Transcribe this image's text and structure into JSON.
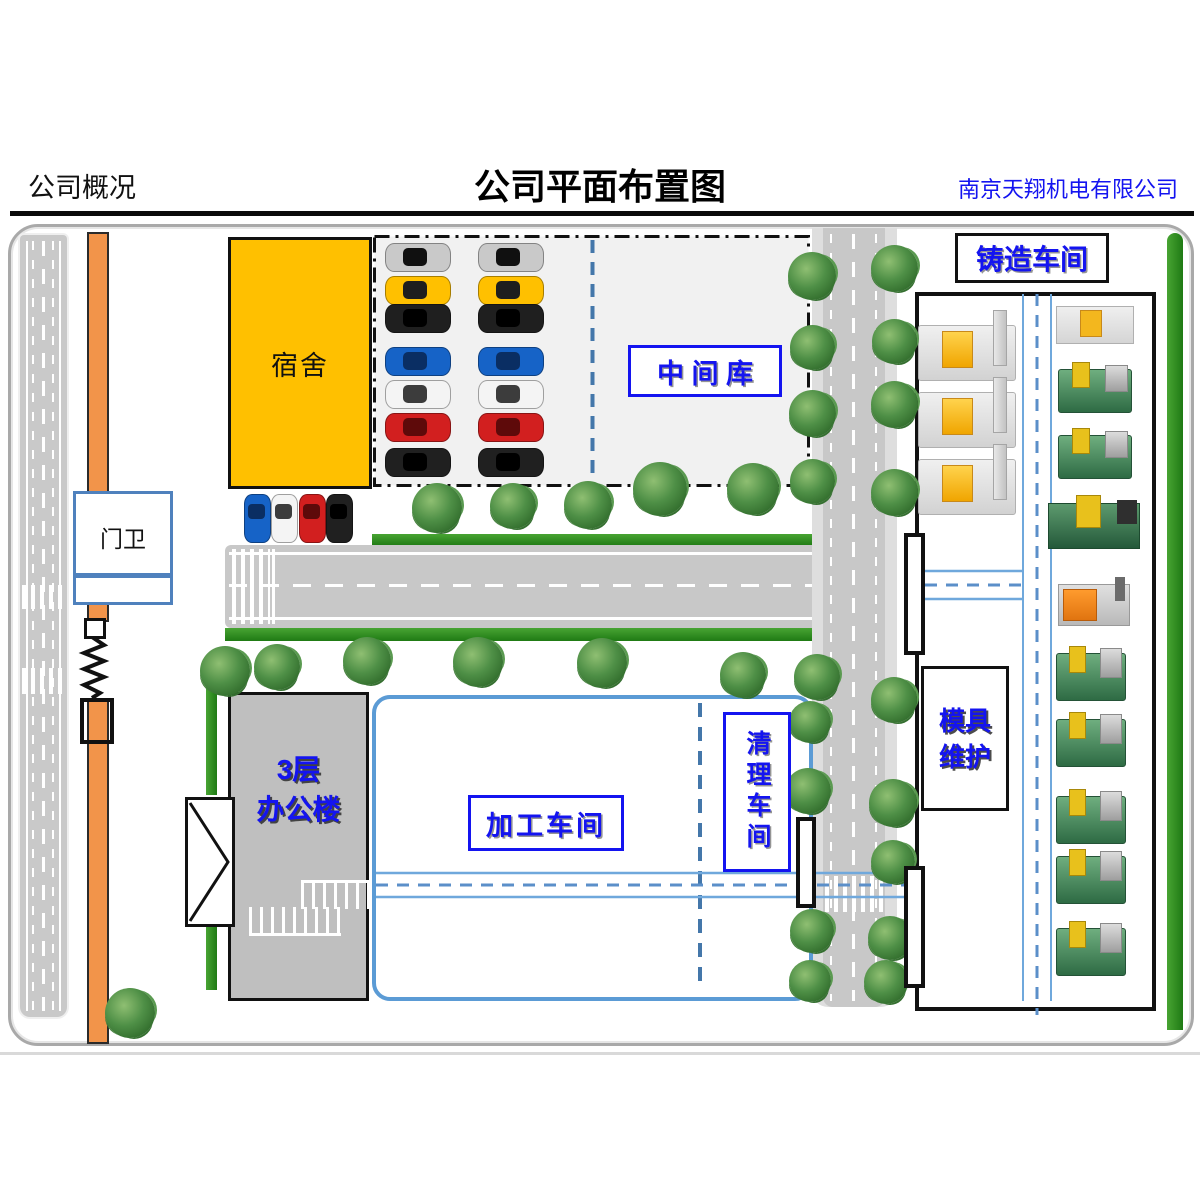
{
  "header": {
    "section_label": "公司概况",
    "title": "公司平面布置图",
    "company_name": "南京天翔机电有限公司"
  },
  "labels": {
    "dormitory": "宿舍",
    "gatehouse": "门卫",
    "intermediate_warehouse": "中 间 库",
    "casting_workshop": "铸造车间",
    "mold_maintenance_line1": "模具",
    "mold_maintenance_line2": "维护",
    "office_line1": "3层",
    "office_line2": "办公楼",
    "processing_workshop": "加工车间",
    "cleaning_workshop": "清理车间"
  },
  "colors": {
    "label_blue": "#1414f0",
    "box_border_blue": "#5b9bd5",
    "aisle_blue": "#6fa8dc",
    "dormitory_fill": "#ffc000",
    "wall_orange": "#f2944a",
    "road_gray": "#c8c8c8",
    "grass_green": "#2f8f22",
    "parking_fill": "#f1f1f1"
  },
  "map_objects": {
    "trees": [
      {
        "x": 812,
        "y": 276,
        "d": 48
      },
      {
        "x": 812,
        "y": 347,
        "d": 45
      },
      {
        "x": 812,
        "y": 413,
        "d": 47
      },
      {
        "x": 812,
        "y": 481,
        "d": 45
      },
      {
        "x": 894,
        "y": 268,
        "d": 47
      },
      {
        "x": 894,
        "y": 341,
        "d": 45
      },
      {
        "x": 894,
        "y": 404,
        "d": 47
      },
      {
        "x": 894,
        "y": 492,
        "d": 47
      },
      {
        "x": 437,
        "y": 508,
        "d": 50
      },
      {
        "x": 513,
        "y": 506,
        "d": 46
      },
      {
        "x": 588,
        "y": 505,
        "d": 48
      },
      {
        "x": 660,
        "y": 489,
        "d": 54
      },
      {
        "x": 753,
        "y": 489,
        "d": 52
      },
      {
        "x": 225,
        "y": 671,
        "d": 50
      },
      {
        "x": 277,
        "y": 667,
        "d": 46
      },
      {
        "x": 367,
        "y": 661,
        "d": 48
      },
      {
        "x": 478,
        "y": 662,
        "d": 50
      },
      {
        "x": 602,
        "y": 663,
        "d": 50
      },
      {
        "x": 743,
        "y": 675,
        "d": 46
      },
      {
        "x": 817,
        "y": 677,
        "d": 46
      },
      {
        "x": 810,
        "y": 722,
        "d": 42
      },
      {
        "x": 808,
        "y": 791,
        "d": 46
      },
      {
        "x": 812,
        "y": 931,
        "d": 44
      },
      {
        "x": 810,
        "y": 981,
        "d": 42
      },
      {
        "x": 894,
        "y": 700,
        "d": 46
      },
      {
        "x": 893,
        "y": 803,
        "d": 48
      },
      {
        "x": 893,
        "y": 862,
        "d": 44
      },
      {
        "x": 890,
        "y": 938,
        "d": 44
      },
      {
        "x": 886,
        "y": 982,
        "d": 44
      },
      {
        "x": 130,
        "y": 1013,
        "d": 50
      }
    ],
    "parking_cars": [
      {
        "x": 385,
        "y": 243,
        "body": "#c9c9c9",
        "glass": "#101010"
      },
      {
        "x": 478,
        "y": 243,
        "body": "#c9c9c9",
        "glass": "#101010"
      },
      {
        "x": 385,
        "y": 276,
        "body": "#ffc000",
        "glass": "#1e1e1e"
      },
      {
        "x": 478,
        "y": 276,
        "body": "#ffc000",
        "glass": "#1e1e1e"
      },
      {
        "x": 385,
        "y": 304,
        "body": "#1f1f1f",
        "glass": "#000000"
      },
      {
        "x": 478,
        "y": 304,
        "body": "#1f1f1f",
        "glass": "#000000"
      },
      {
        "x": 385,
        "y": 347,
        "body": "#1663c7",
        "glass": "#0a2e63"
      },
      {
        "x": 478,
        "y": 347,
        "body": "#1663c7",
        "glass": "#0a2e63"
      },
      {
        "x": 385,
        "y": 380,
        "body": "#f4f4f4",
        "glass": "#3c3c3c"
      },
      {
        "x": 478,
        "y": 380,
        "body": "#f4f4f4",
        "glass": "#3c3c3c"
      },
      {
        "x": 385,
        "y": 413,
        "body": "#d21f1f",
        "glass": "#5e0a0a"
      },
      {
        "x": 478,
        "y": 413,
        "body": "#d21f1f",
        "glass": "#5e0a0a"
      },
      {
        "x": 385,
        "y": 448,
        "body": "#202020",
        "glass": "#000000"
      },
      {
        "x": 478,
        "y": 448,
        "body": "#202020",
        "glass": "#000000"
      }
    ],
    "small_cars": [
      {
        "x": 244,
        "y": 494,
        "body": "#1663c7",
        "glass": "#0a2e63"
      },
      {
        "x": 271,
        "y": 494,
        "body": "#f4f4f4",
        "glass": "#3c3c3c"
      },
      {
        "x": 299,
        "y": 494,
        "body": "#d21f1f",
        "glass": "#5e0a0a"
      },
      {
        "x": 326,
        "y": 494,
        "body": "#202020",
        "glass": "#000000"
      }
    ],
    "machines": [
      {
        "type": "diecast",
        "x": 918,
        "y": 325,
        "w": 96,
        "h": 54
      },
      {
        "type": "diecast",
        "x": 918,
        "y": 392,
        "w": 96,
        "h": 54
      },
      {
        "type": "diecast",
        "x": 918,
        "y": 459,
        "w": 96,
        "h": 54
      },
      {
        "type": "wy-small",
        "x": 1056,
        "y": 306,
        "w": 76,
        "h": 36
      },
      {
        "type": "green-med",
        "x": 1058,
        "y": 369,
        "w": 72,
        "h": 42
      },
      {
        "type": "green-med",
        "x": 1058,
        "y": 435,
        "w": 72,
        "h": 42
      },
      {
        "type": "green-large",
        "x": 1048,
        "y": 503,
        "w": 90,
        "h": 44
      },
      {
        "type": "orange-truck",
        "x": 1058,
        "y": 584,
        "w": 70,
        "h": 40
      },
      {
        "type": "green-yellow",
        "x": 1056,
        "y": 653,
        "w": 68,
        "h": 46
      },
      {
        "type": "green-yellow",
        "x": 1056,
        "y": 719,
        "w": 68,
        "h": 46
      },
      {
        "type": "green-yellow",
        "x": 1056,
        "y": 796,
        "w": 68,
        "h": 46
      },
      {
        "type": "green-yellow",
        "x": 1056,
        "y": 856,
        "w": 68,
        "h": 46
      },
      {
        "type": "green-yellow",
        "x": 1056,
        "y": 928,
        "w": 68,
        "h": 46
      }
    ]
  }
}
